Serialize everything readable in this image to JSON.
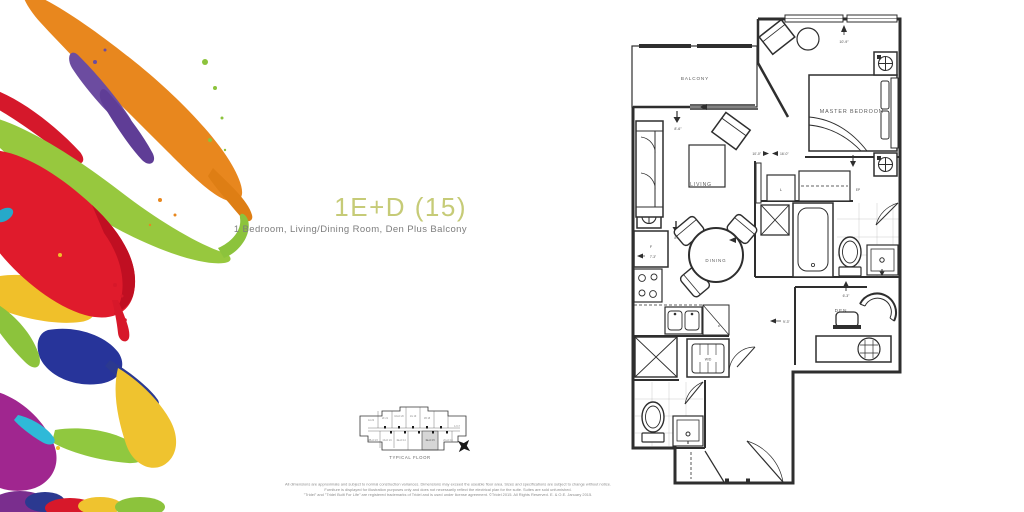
{
  "unit": {
    "title": "1E+D (15)",
    "subtitle": "1 Bedroom, Living/Dining Room, Den Plus Balcony",
    "accent_color": "#c6cb77"
  },
  "floor_plan": {
    "rooms": {
      "balcony": "BALCONY",
      "master_bedroom": "MASTER BEDROOM",
      "living": "LIVING",
      "dining": "DINING",
      "den": "DEN"
    },
    "fixtures": {
      "linen": "L",
      "electrical_panel": "EP",
      "fridge": "F",
      "dishwasher": "D",
      "washer_dryer": "W/D"
    },
    "dimensions": {
      "master_bedroom": "10'-9\"",
      "living_width": "10'-0\"",
      "living_length": "16'-0\"",
      "balcony": "8'-6\"",
      "kitchen": "8'-6\"",
      "fridge_wall": "7'-3\"",
      "den_width": "6'-3\"",
      "den_length": "9'-3\""
    }
  },
  "key_plan": {
    "caption": "TYPICAL FLOOR",
    "highlighted_unit": "1E+D 15",
    "highlight_color": "#d6d6d6",
    "units": [
      {
        "text": "1A 22"
      },
      {
        "text": "2F 21"
      },
      {
        "text": "1D+D 20"
      },
      {
        "text": "1G 19"
      },
      {
        "text": "1B 18"
      },
      {
        "text": "1J 17"
      },
      {
        "text": "2B+D 23"
      },
      {
        "text": "1F+D 24"
      },
      {
        "text": "1E+D 14"
      },
      {
        "text": "2C+D 16"
      }
    ]
  },
  "disclaimer": {
    "line1": "All dimensions are approximate and subject to normal construction variances. Dimensions may exceed the useable floor area. Sizes and specifications are subject to change without notice.",
    "line2": "Furniture is displayed for illustration purposes only and does not necessarily reflect the electrical plan for the suite. Suites are sold unfurnished.",
    "line3": "\"Tridel\" and \"Tridel Built For Life\" are registered trademarks of Tridel and is used under license agreement. ©Tridel 2015. All Rights Reserved. E. & O.E. January 2015."
  }
}
